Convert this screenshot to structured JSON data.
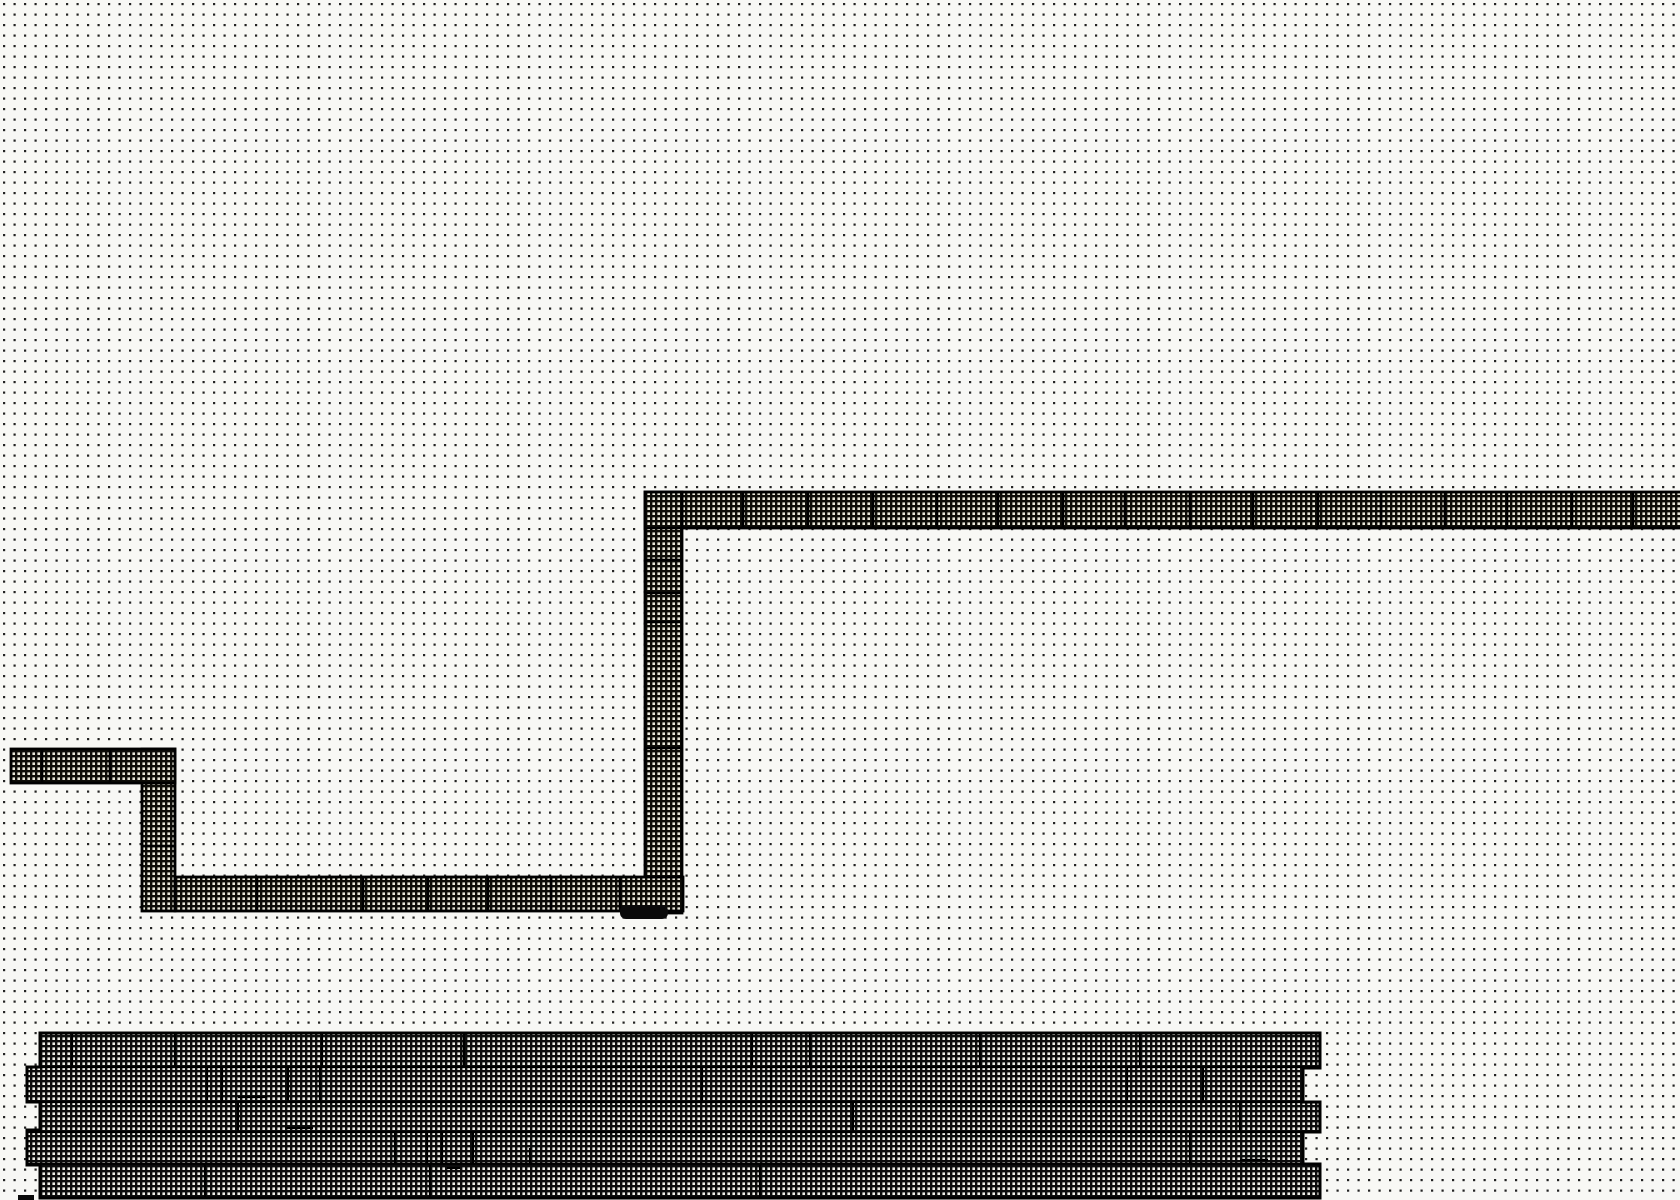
{
  "canvas": {
    "width": 1680,
    "height": 1200,
    "background_color": "#f8f8f5",
    "grid": {
      "spacing": 10.5,
      "dot_size": 2.2,
      "dot_offset": 3,
      "dot_color": "#232323"
    }
  },
  "styles": {
    "outline_color": "#000000",
    "wire_outline_width": 2.8,
    "wire_divider_width": 2.6,
    "slab_outline_width": 3,
    "slab_inner_width": 2.2,
    "wire_hatch": {
      "period": 5,
      "line": 2.4,
      "line_color": "#0e0d08",
      "cell_color": "#eae8da"
    },
    "slab_hatch": {
      "period": 5,
      "line": 2.4,
      "line_color": "#0d0d0d",
      "cell_color": "#efeee8"
    }
  },
  "wires": [
    {
      "name": "wire-top-horizontal-bar",
      "x": 645,
      "y": 492,
      "w": 1040,
      "h": 36,
      "dividers_x": [
        682,
        743,
        808,
        873,
        937,
        998,
        1063,
        1125,
        1190,
        1253,
        1318,
        1381,
        1445,
        1507,
        1572,
        1633
      ]
    },
    {
      "name": "wire-right-vertical-bar",
      "x": 645,
      "y": 492,
      "w": 37,
      "h": 421,
      "dividers_y": [
        528,
        560,
        593,
        622,
        748
      ]
    },
    {
      "name": "wire-bottom-horizontal-bar",
      "x": 175,
      "y": 877,
      "w": 508,
      "h": 34,
      "dividers_x": [
        257,
        363,
        428,
        488,
        551,
        620
      ]
    },
    {
      "name": "wire-left-vertical-bar",
      "x": 142,
      "y": 749,
      "w": 33,
      "h": 162,
      "dividers_y": [
        783,
        846
      ]
    },
    {
      "name": "wire-top-left-horizontal-bar",
      "x": 11,
      "y": 749,
      "w": 164,
      "h": 34,
      "dividers_x": [
        42,
        110
      ]
    }
  ],
  "bump": {
    "x": 620,
    "y": 905,
    "w": 48,
    "h": 14,
    "r": 6,
    "color": "#0a0a0a"
  },
  "corner_fragment": {
    "x": 18,
    "y": 1195,
    "w": 16,
    "h": 5,
    "color": "#0a0a0a"
  },
  "slab": {
    "outline_points": [
      [
        40,
        1033
      ],
      [
        1320,
        1033
      ],
      [
        1320,
        1068
      ],
      [
        1303,
        1068
      ],
      [
        1303,
        1102
      ],
      [
        1320,
        1102
      ],
      [
        1320,
        1132
      ],
      [
        1303,
        1132
      ],
      [
        1303,
        1164
      ],
      [
        1320,
        1164
      ],
      [
        1320,
        1198
      ],
      [
        40,
        1198
      ],
      [
        40,
        1165
      ],
      [
        27,
        1165
      ],
      [
        27,
        1130
      ],
      [
        40,
        1130
      ],
      [
        40,
        1102
      ],
      [
        27,
        1102
      ],
      [
        27,
        1067
      ],
      [
        40,
        1067
      ]
    ],
    "band_lines": [
      {
        "y": 1067,
        "x1": 28,
        "x2": 1318
      },
      {
        "y": 1102,
        "x1": 28,
        "x2": 1318
      },
      {
        "y": 1132,
        "x1": 28,
        "x2": 1318
      },
      {
        "y": 1164,
        "x1": 28,
        "x2": 1318
      }
    ],
    "v_lines": [
      [
        72,
        1033,
        1067
      ],
      [
        175,
        1033,
        1067
      ],
      [
        322,
        1033,
        1067
      ],
      [
        464,
        1033,
        1067
      ],
      [
        752,
        1033,
        1067
      ],
      [
        810,
        1033,
        1067
      ],
      [
        980,
        1033,
        1067
      ],
      [
        1140,
        1033,
        1067
      ],
      [
        207,
        1067,
        1102
      ],
      [
        222,
        1067,
        1102
      ],
      [
        288,
        1067,
        1102
      ],
      [
        320,
        1067,
        1102
      ],
      [
        702,
        1067,
        1102
      ],
      [
        771,
        1067,
        1102
      ],
      [
        1127,
        1067,
        1102
      ],
      [
        1203,
        1067,
        1102
      ],
      [
        238,
        1102,
        1132
      ],
      [
        853,
        1102,
        1132
      ],
      [
        1240,
        1102,
        1132
      ],
      [
        395,
        1132,
        1164
      ],
      [
        427,
        1132,
        1164
      ],
      [
        442,
        1132,
        1164
      ],
      [
        473,
        1132,
        1164
      ],
      [
        530,
        1148,
        1164
      ],
      [
        1190,
        1132,
        1164
      ],
      [
        205,
        1164,
        1198
      ],
      [
        430,
        1164,
        1198
      ],
      [
        760,
        1164,
        1198
      ]
    ],
    "h_ticks": [
      [
        238,
        267,
        1097
      ],
      [
        285,
        313,
        1128
      ],
      [
        447,
        460,
        1168
      ],
      [
        1240,
        1268,
        1160
      ]
    ]
  }
}
